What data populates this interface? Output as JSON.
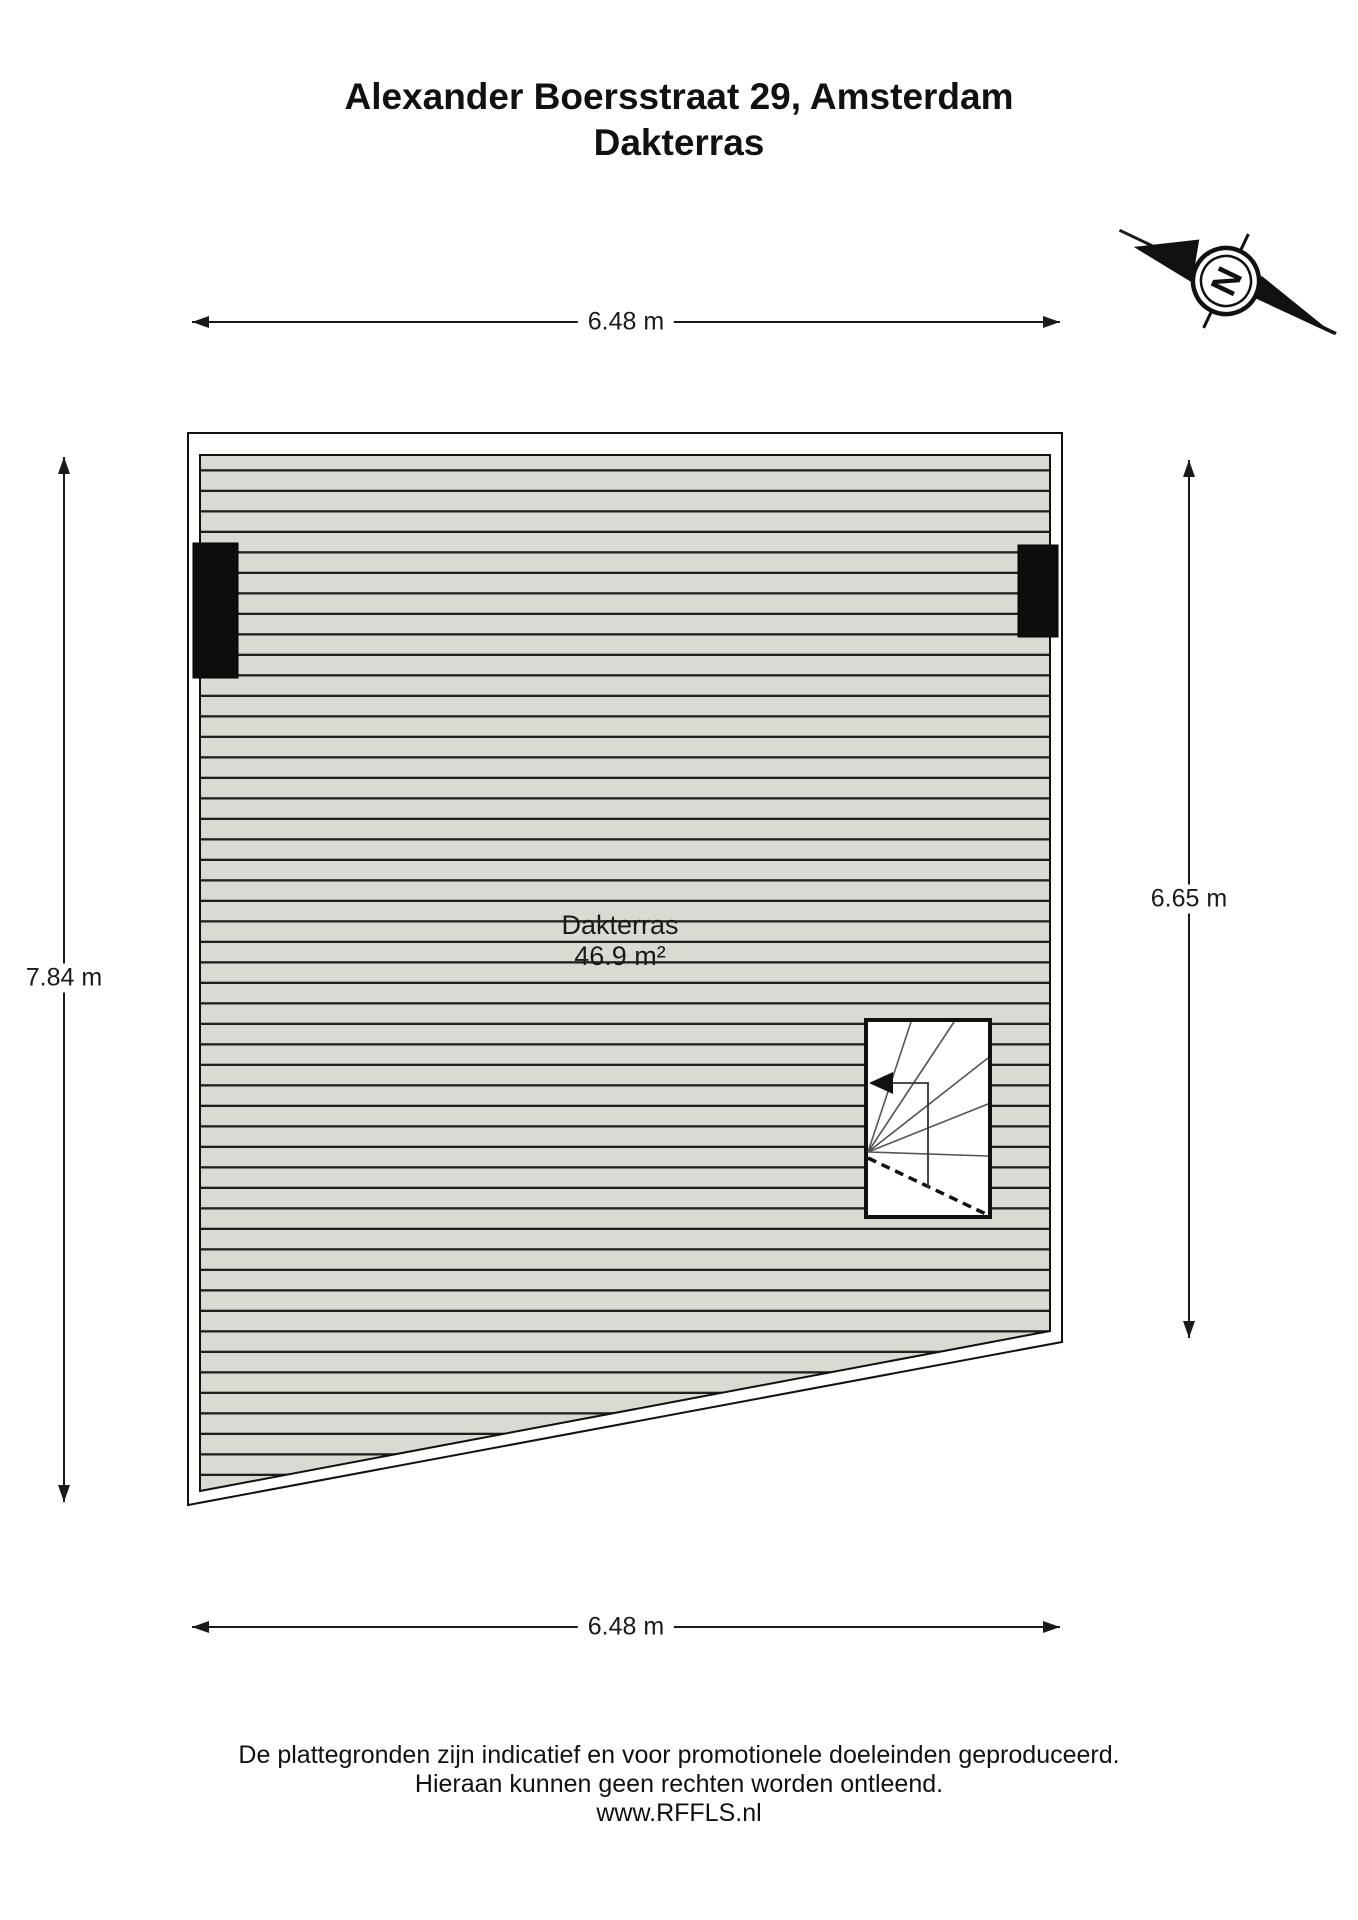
{
  "title": {
    "line1": "Alexander Boersstraat 29, Amsterdam",
    "line2": "Dakterras"
  },
  "compass": {
    "label": "N"
  },
  "dimensions": {
    "top": "6.48 m",
    "bottom": "6.48 m",
    "left": "7.84 m",
    "right": "6.65 m"
  },
  "room": {
    "name": "Dakterras",
    "area": "46.9 m²"
  },
  "footer": {
    "line1": "De plattegronden zijn indicatief en voor promotionele doeleinden geproduceerd.",
    "line2": "Hieraan kunnen geen rechten worden ontleend.",
    "line3": "www.RFFLS.nl"
  },
  "colors": {
    "background": "#ffffff",
    "ink": "#1a1a1a",
    "deck_fill": "#dbdad2",
    "deck_line": "#1f1f1f",
    "wall_fill": "#ffffff",
    "chimney": "#0d0d0d"
  }
}
